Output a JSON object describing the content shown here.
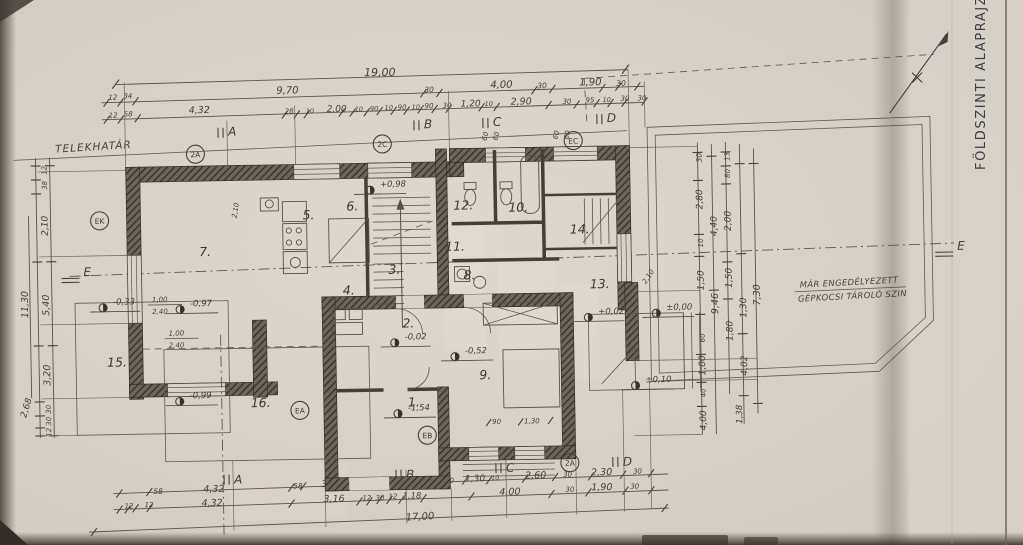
{
  "document": {
    "side_title": "FÖLDSZINTI ALAPRAJZ",
    "property_line_label": "TELEKHATÁR",
    "garage_note_line1": "MÁR ENGEDÉLYEZETT",
    "garage_note_line2": "GÉPKOCSI TÁROLÓ SZIN"
  },
  "axes": {
    "top": [
      "A",
      "B",
      "C",
      "D"
    ],
    "bottom": [
      "A",
      "B",
      "C",
      "D"
    ],
    "left": "E",
    "right": "E"
  },
  "section_markers": {
    "top_left": "2A",
    "top_mid": "2C",
    "top_right": "EC",
    "left": "EK",
    "mid_left": "EA",
    "mid": "EB",
    "bottom_right": "2A"
  },
  "rooms": [
    "1.",
    "2.",
    "3.",
    "4.",
    "5.",
    "6.",
    "7.",
    "8.",
    "9.",
    "10.",
    "11.",
    "12.",
    "13.",
    "14.",
    "15.",
    "16."
  ],
  "levels": {
    "stairs": "+0,98",
    "room2": "-0,02",
    "room9": "-0,52",
    "terrace": "±0,00",
    "terrace2": "+0,02",
    "step": "±0,10",
    "left1": "-0,33",
    "left2": "-0,97",
    "left3": "-0,99",
    "entry": "-1,54"
  },
  "dims": {
    "top_total": "19,00",
    "top_row2": [
      "12",
      "34",
      "9,70",
      "30",
      "4,00",
      "30",
      "1,90",
      "30"
    ],
    "top_row3": [
      "12",
      "58",
      "4,32",
      "28",
      "10",
      "2,00",
      "10",
      "90",
      "10",
      "90",
      "10",
      "90",
      "30",
      "1,20",
      "10",
      "2,90",
      "30",
      "95",
      "10",
      "30",
      "30"
    ],
    "bottom_row1": [
      "58",
      "4,32",
      "58",
      "3,00",
      "10",
      "1,90",
      "30",
      "1,30",
      "10",
      "2,60",
      "30",
      "2,30",
      "30"
    ],
    "bottom_row2": [
      "12",
      "12",
      "4,32",
      "3,16",
      "12",
      "30",
      "12",
      "1,18",
      "4,00",
      "30",
      "1,90",
      "30"
    ],
    "bottom_total": "17,00",
    "left_col": [
      "12",
      "38",
      "2,10",
      "5,40",
      "3,20",
      "30",
      "30",
      "12",
      "11,30",
      "2,68"
    ],
    "right_col": [
      "30",
      "2,80",
      "10",
      "1,50",
      "60",
      "1,00",
      "40",
      "4,00",
      "4,40",
      "9,46",
      "13",
      "80",
      "2,00",
      "1,50",
      "1,80",
      "1,30",
      "7,30",
      "4,02",
      "1,38"
    ],
    "win_left_a": [
      "1,00",
      "2,40"
    ],
    "win_left_b": [
      "1,00",
      "2,40"
    ],
    "win_top_a": [
      "60",
      "60"
    ],
    "win_top_b": [
      "60",
      "60"
    ],
    "win_bottom": [
      "90",
      "1,30"
    ],
    "door_a": "2,10",
    "door_b": "2,10"
  }
}
